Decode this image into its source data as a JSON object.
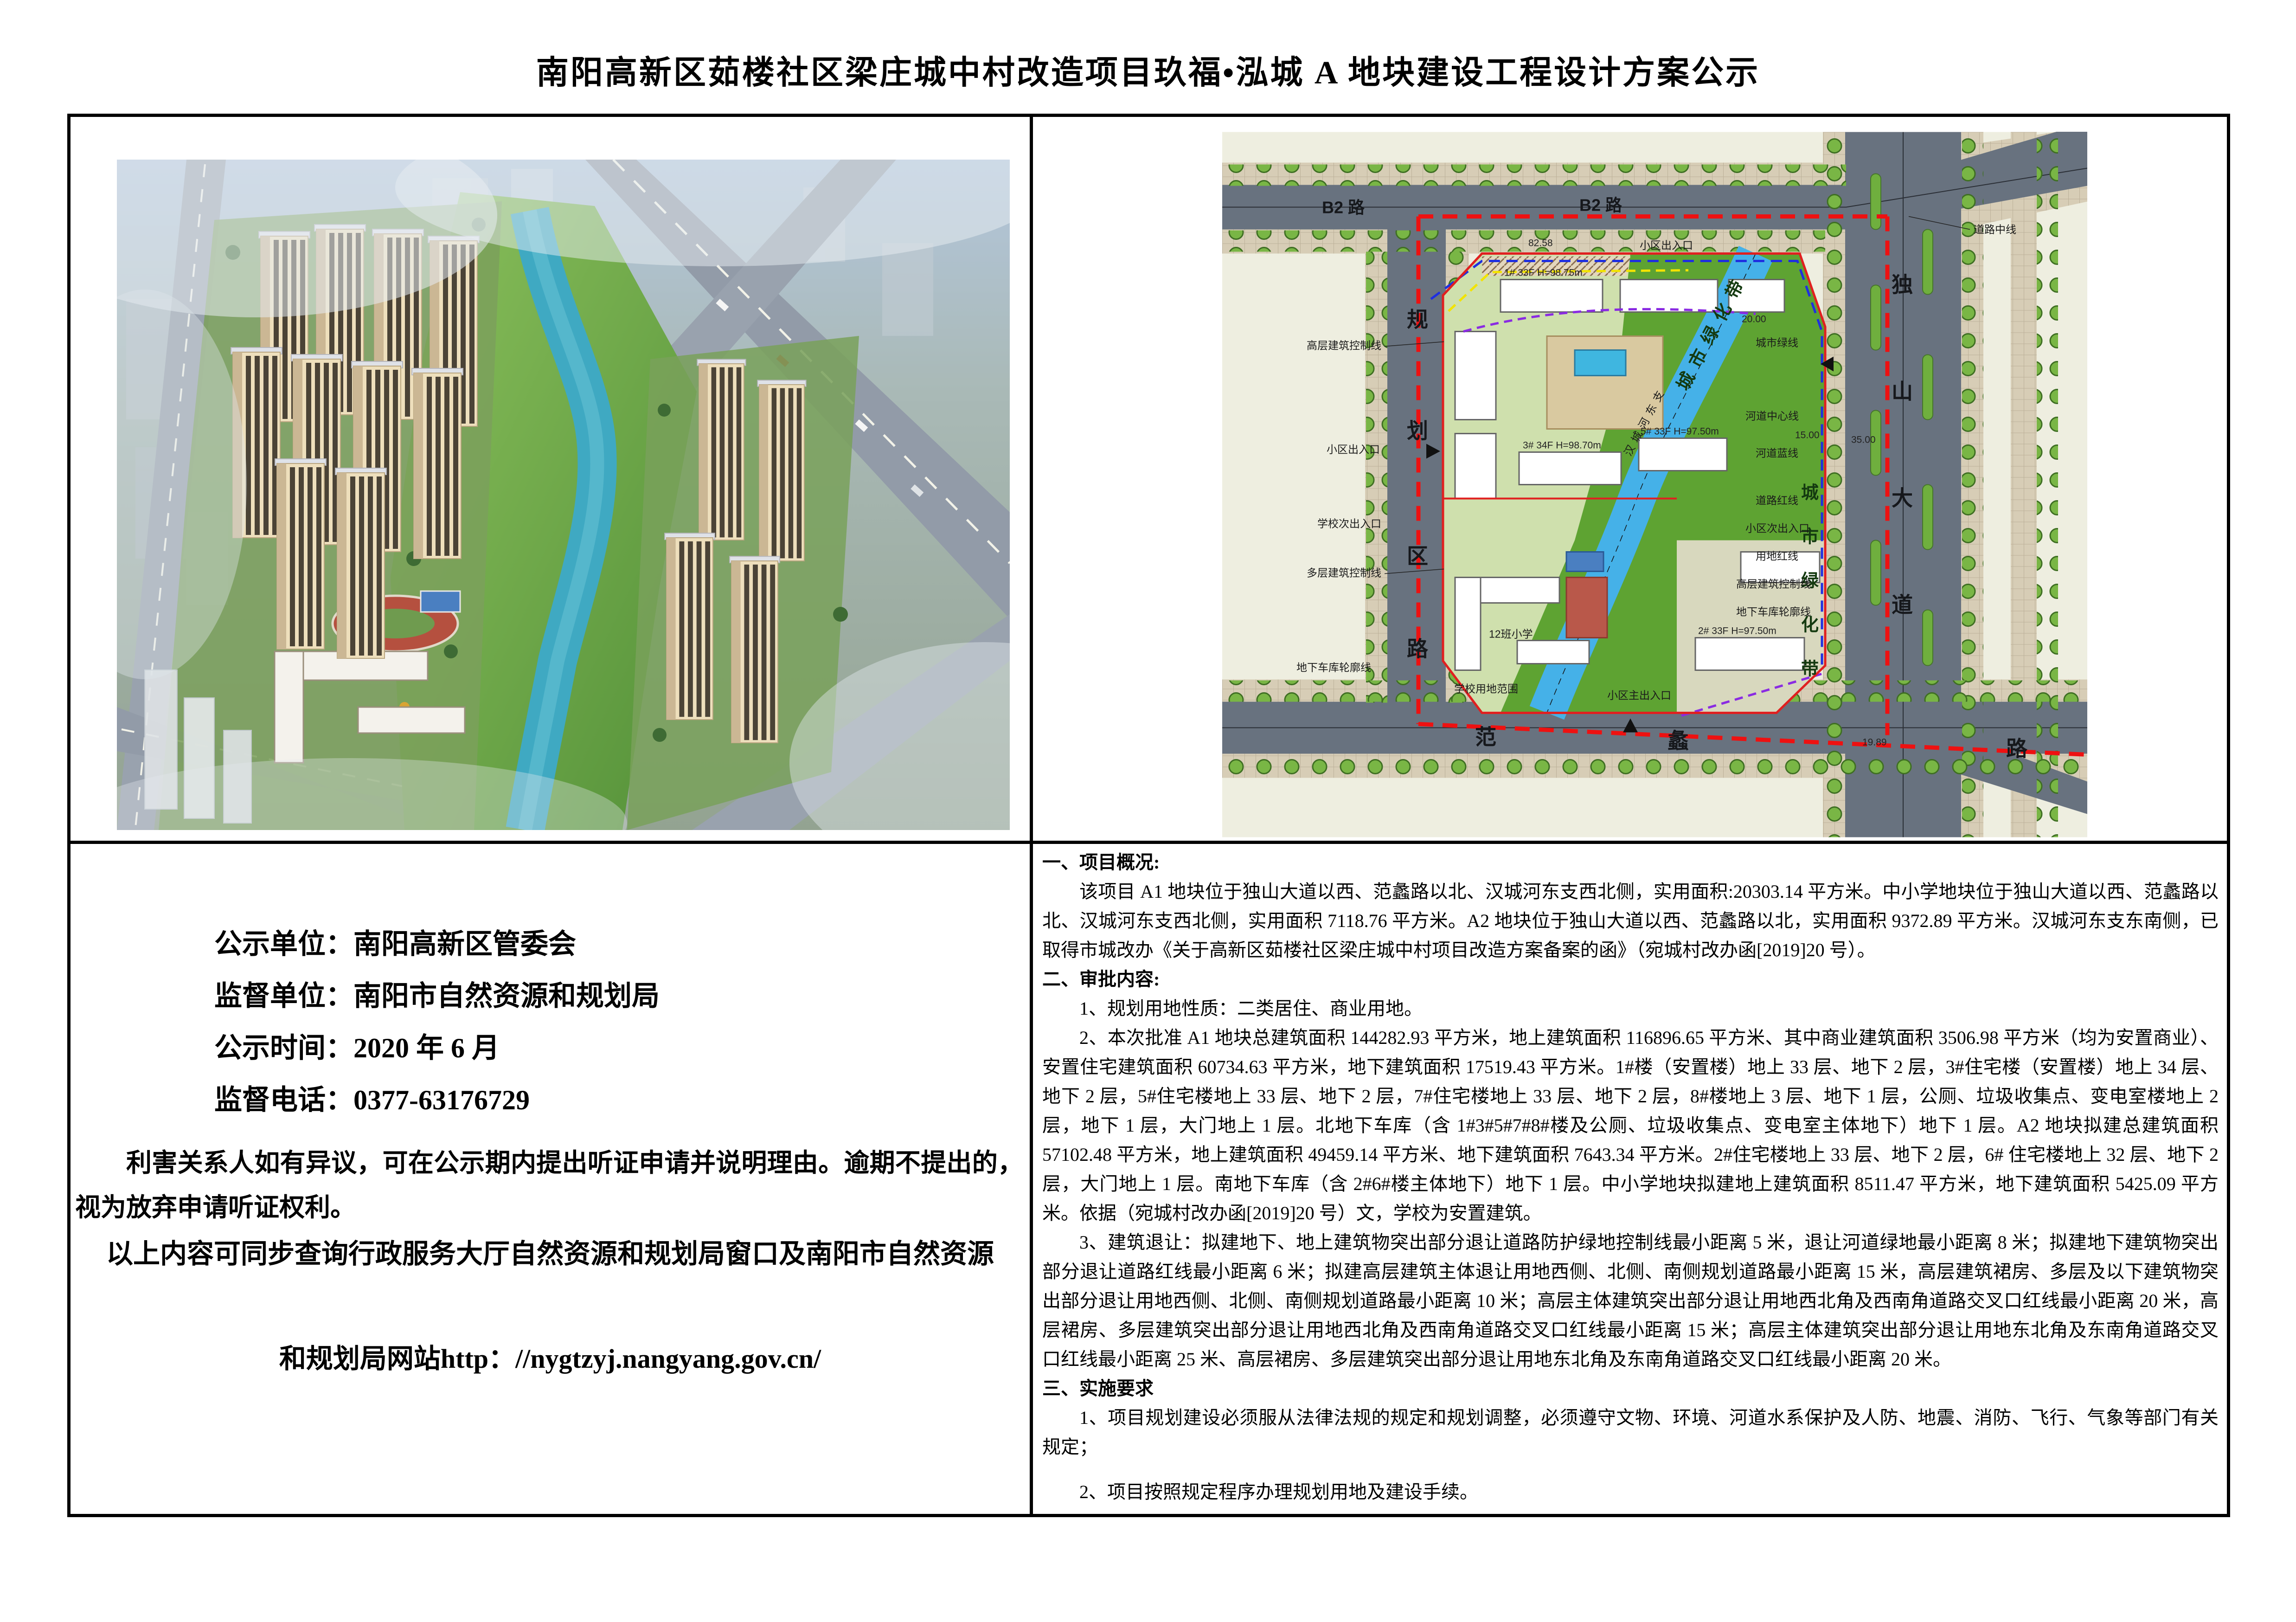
{
  "page": {
    "title": "南阳高新区茹楼社区梁庄城中村改造项目玖福•泓城 A 地块建设工程设计方案公示"
  },
  "notice": {
    "publicity_unit_label": "公示单位：",
    "publicity_unit": "南阳高新区管委会",
    "supervision_unit_label": "监督单位：",
    "supervision_unit": "南阳市自然资源和规划局",
    "publicity_time_label": "公示时间：",
    "publicity_time": "2020 年 6 月",
    "supervision_phone_label": "监督电话：",
    "supervision_phone": "0377-63176729",
    "objection_paragraph": "利害关系人如有异议，可在公示期内提出听证申请并说明理由。逾期不提出的，视为放弃申请听证权利。",
    "query_line1": "以上内容可同步查询行政服务大厅自然资源和规划局窗口及南阳市自然资源",
    "query_line2": "和规划局网站http：//nygtzyj.nangyang.gov.cn/"
  },
  "details": {
    "section1_title": "一、项目概况:",
    "section1_body": "该项目 A1 地块位于独山大道以西、范蠡路以北、汉城河东支西北侧，实用面积:20303.14 平方米。中小学地块位于独山大道以西、范蠡路以北、汉城河东支西北侧，实用面积 7118.76 平方米。A2 地块位于独山大道以西、范蠡路以北，实用面积 9372.89 平方米。汉城河东支东南侧，已取得市城改办《关于高新区茹楼社区梁庄城中村项目改造方案备案的函》（宛城村改办函[2019]20 号）。",
    "section2_title": "二、审批内容:",
    "item2_1": "1、规划用地性质：二类居住、商业用地。",
    "item2_2": "2、本次批准 A1 地块总建筑面积 144282.93 平方米，地上建筑面积 116896.65 平方米、其中商业建筑面积 3506.98 平方米（均为安置商业）、安置住宅建筑面积 60734.63 平方米，地下建筑面积 17519.43 平方米。1#楼（安置楼）地上 33 层、地下 2 层，3#住宅楼（安置楼）地上 34 层、地下 2 层，5#住宅楼地上 33 层、地下 2 层，7#住宅楼地上 33 层、地下 2 层，8#楼地上 3 层、地下 1 层，公厕、垃圾收集点、变电室楼地上 2 层，地下 1 层，大门地上 1 层。北地下车库（含 1#3#5#7#8#楼及公厕、垃圾收集点、变电室主体地下）地下 1 层。A2 地块拟建总建筑面积 57102.48 平方米，地上建筑面积 49459.14 平方米、地下建筑面积 7643.34 平方米。2#住宅楼地上 33 层、地下 2 层，6# 住宅楼地上 32 层、地下 2 层，大门地上 1 层。南地下车库（含 2#6#楼主体地下）地下 1 层。中小学地块拟建地上建筑面积 8511.47 平方米，地下建筑面积 5425.09 平方米。依据（宛城村改办函[2019]20 号）文，学校为安置建筑。",
    "item2_3": "3、建筑退让：拟建地下、地上建筑物突出部分退让道路防护绿地控制线最小距离 5 米，退让河道绿地最小距离 8 米；拟建地下建筑物突出部分退让道路红线最小距离 6 米；拟建高层建筑主体退让用地西侧、北侧、南侧规划道路最小距离 15 米，高层建筑裙房、多层及以下建筑物突出部分退让用地西侧、北侧、南侧规划道路最小距离 10 米；高层主体建筑突出部分退让用地西北角及西南角道路交叉口红线最小距离 20 米，高层裙房、多层建筑突出部分退让用地西北角及西南角道路交叉口红线最小距离 15 米；高层主体建筑突出部分退让用地东北角及东南角道路交叉口红线最小距离 25 米、高层裙房、多层建筑突出部分退让用地东北角及东南角道路交叉口红线最小距离 20 米。",
    "section3_title": "三、实施要求",
    "item3_1": "1、项目规划建设必须服从法律法规的规定和规划调整，必须遵守文物、环境、河道水系保护及人防、地震、消防、飞行、气象等部门有关规定；",
    "item3_2": "2、项目按照规定程序办理规划用地及建设手续。"
  },
  "site_plan": {
    "b2_road": "B2 路",
    "dushan": [
      "独",
      "山",
      "大",
      "道"
    ],
    "guihua": [
      "规",
      "划",
      "区",
      "路"
    ],
    "fanli": [
      "范",
      "蠡",
      "路"
    ],
    "belt_vert": [
      "城",
      "市",
      "绿",
      "化",
      "带"
    ],
    "belt_diag": "城市绿化带",
    "river_name": "汉城河东支",
    "ann": {
      "daolu_zhongxian": "道路中线",
      "chengshi_lvxian": "城市绿线",
      "hedao_zhongxinxian": "河道中心线",
      "hedao_lanxian": "河道蓝线",
      "daolu_hongxian": "道路红线",
      "yongdi_hongxian": "用地红线",
      "gaoceng_kongzhixian": "高层建筑控制线",
      "duoceng_kongzhixian": "多层建筑控制线",
      "dixia_cheku": "地下车库轮廓线",
      "xiaoqu_churukou": "小区出入口",
      "xiaoqu_ci_churukou": "小区次出入口",
      "xiaoqu_zhu_churukou": "小区主出入口",
      "xuexiao_ci_churukou": "学校次出入口",
      "xuexiao_fanwei": "学校用地范围",
      "school_label": "12班小学"
    },
    "bldg": {
      "t1": "1# 33F H=98.75m",
      "t3": "3# 34F H=98.70m",
      "t5": "5# 33F H=97.50m",
      "t2": "2# 33F H=97.50m"
    },
    "dims": {
      "d35": "35.00",
      "d20": "20.00",
      "d15": "15.00",
      "d8258": "82.58",
      "d1989": "19.89"
    }
  }
}
